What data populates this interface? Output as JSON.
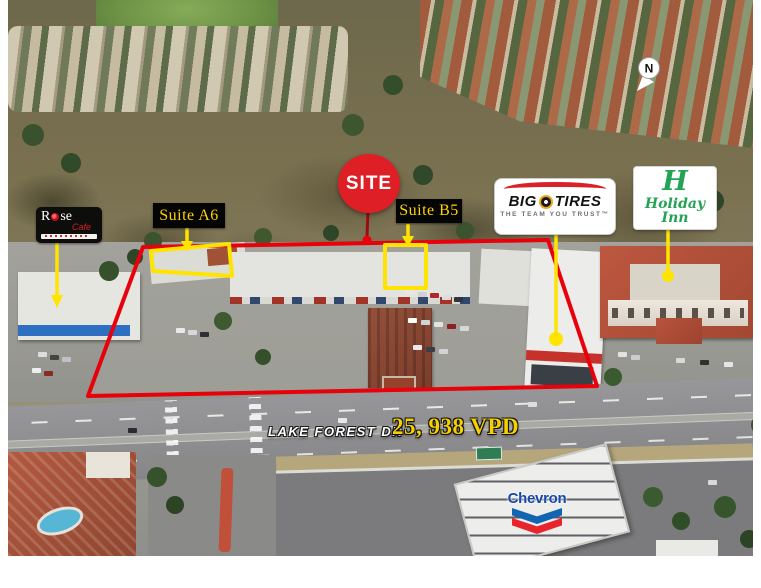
{
  "colors": {
    "outline_red": "#E8000B",
    "highlight_yellow": "#FFE400",
    "label_yellow": "#FFD400",
    "site_red": "#DE1F26",
    "bigo_red": "#D92128",
    "holiday_green": "#23A455",
    "chevron_blue": "#1265B0",
    "chevron_wordmark_blue": "#1849A9",
    "chevron_red": "#E8252D",
    "vpd_yellow": "#F5CF00"
  },
  "annotations": {
    "site_badge": {
      "label": "SITE"
    },
    "suite_a6": {
      "label": "Suite A6"
    },
    "suite_b5": {
      "label": "Suite B5"
    },
    "north": {
      "label": "N"
    },
    "road": {
      "name": "LAKE FOREST DR",
      "traffic_count": "25, 938 VPD"
    }
  },
  "logos": {
    "rose_cafe": {
      "name_part1": "R",
      "name_part2": "se",
      "line2": "Cafe"
    },
    "big_o_tires": {
      "brand_left": "BIG",
      "brand_right": "TIRES",
      "tagline": "THE TEAM YOU TRUST™"
    },
    "holiday_inn": {
      "monogram": "H",
      "name": "Holiday Inn"
    },
    "chevron": {
      "wordmark": "Chevron"
    }
  }
}
